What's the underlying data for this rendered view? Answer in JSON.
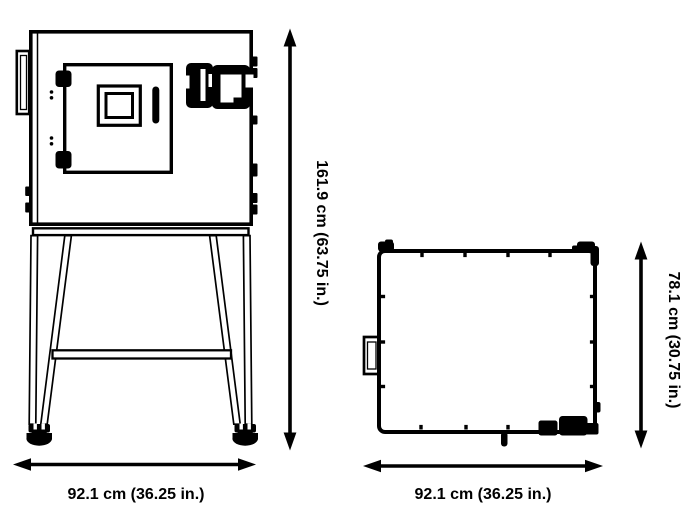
{
  "diagram": {
    "description": "Technical dimension drawing of an environmental test chamber: front view on stand (left) and top view (right)",
    "colors": {
      "line": "#000000",
      "background": "#ffffff"
    },
    "views": {
      "front": {
        "height_label": "161.9 cm (63.75 in.)",
        "width_label": "92.1 cm (36.25 in.)"
      },
      "top": {
        "height_label": "78.1 cm (30.75 in.)",
        "width_label": "92.1 cm (36.25 in.)"
      }
    }
  }
}
